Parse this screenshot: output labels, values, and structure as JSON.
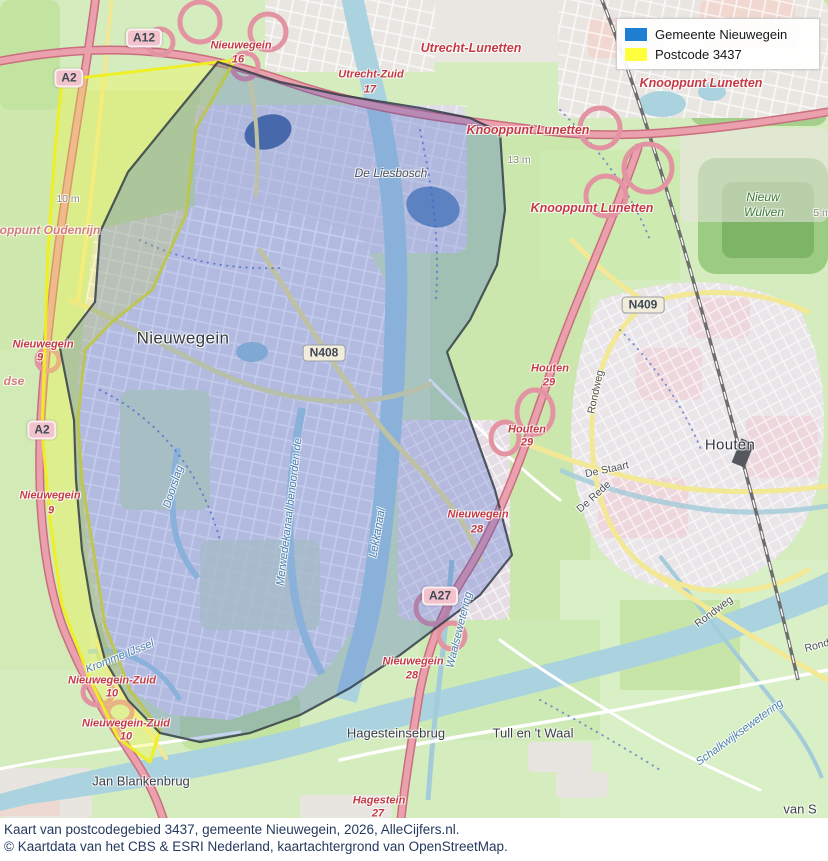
{
  "legend": {
    "items": [
      {
        "label": "Gemeente Nieuwegein",
        "color": "#1e7fd2"
      },
      {
        "label": "Postcode 3437",
        "color": "#ffff3d"
      }
    ]
  },
  "caption": {
    "line1": "Kaart van postcodegebied 3437, gemeente Nieuwegein, 2026, AlleCijfers.nl.",
    "line2": "© Kaartdata van het CBS & ESRI Nederland, kaartachtergrond van OpenStreetMap."
  },
  "map": {
    "overlay_colors": {
      "gemeente_fill": "rgba(40,80,200,0.30)",
      "postcode_fill": "rgba(250,250,60,0.32)"
    },
    "labels": [
      {
        "name": "shield-a12",
        "kind": "shield-a",
        "text": "A12",
        "x": 144,
        "y": 38
      },
      {
        "name": "shield-a2-north",
        "kind": "shield-a",
        "text": "A2",
        "x": 69,
        "y": 78
      },
      {
        "name": "shield-a2-mid",
        "kind": "shield-a",
        "text": "A2",
        "x": 42,
        "y": 430
      },
      {
        "name": "shield-a27",
        "kind": "shield-a",
        "text": "A27",
        "x": 440,
        "y": 596
      },
      {
        "name": "shield-n408",
        "kind": "shield-n",
        "text": "N408",
        "x": 324,
        "y": 353
      },
      {
        "name": "shield-n409",
        "kind": "shield-n",
        "text": "N409",
        "x": 643,
        "y": 305
      },
      {
        "name": "exit-nieuwegein-16",
        "kind": "exit",
        "text": "Nieuwegein",
        "x": 241,
        "y": 46
      },
      {
        "name": "exit-nieuwegein-16-nr",
        "kind": "exit",
        "text": "16",
        "x": 238,
        "y": 60
      },
      {
        "name": "exit-utrecht-zuid",
        "kind": "exit",
        "text": "Utrecht-Zuid",
        "x": 371,
        "y": 75
      },
      {
        "name": "exit-utrecht-zuid-nr",
        "kind": "exit",
        "text": "17",
        "x": 370,
        "y": 90
      },
      {
        "name": "label-utrecht-lunetten",
        "kind": "junction",
        "text": "Utrecht-Lunetten",
        "x": 471,
        "y": 48
      },
      {
        "name": "label-knooppunt-lunetten-1",
        "kind": "junction",
        "text": "Knooppunt Lunetten",
        "x": 701,
        "y": 83
      },
      {
        "name": "label-knooppunt-lunetten-2",
        "kind": "junction",
        "text": "Knooppunt Lunetten",
        "x": 528,
        "y": 130
      },
      {
        "name": "label-knooppunt-lunetten-3",
        "kind": "junction",
        "text": "Knooppunt Lunetten",
        "x": 592,
        "y": 208
      },
      {
        "name": "label-knooppunt-oudenrijn",
        "kind": "junction-faded",
        "text": "oppunt Oudenrijn",
        "x": 50,
        "y": 230
      },
      {
        "name": "label-dse-fragment",
        "kind": "junction-faded",
        "text": "dse",
        "x": 14,
        "y": 381
      },
      {
        "name": "exit-nieuwegein-9a",
        "kind": "exit",
        "text": "Nieuwegein",
        "x": 43,
        "y": 345
      },
      {
        "name": "exit-nieuwegein-9a-nr",
        "kind": "exit",
        "text": "9",
        "x": 40,
        "y": 358
      },
      {
        "name": "exit-nieuwegein-9b",
        "kind": "exit",
        "text": "Nieuwegein",
        "x": 50,
        "y": 496
      },
      {
        "name": "exit-nieuwegein-9b-nr",
        "kind": "exit",
        "text": "9",
        "x": 51,
        "y": 511
      },
      {
        "name": "exit-houten-29a",
        "kind": "exit",
        "text": "Houten",
        "x": 550,
        "y": 369
      },
      {
        "name": "exit-houten-29a-nr",
        "kind": "exit",
        "text": "29",
        "x": 549,
        "y": 383
      },
      {
        "name": "exit-houten-29b",
        "kind": "exit",
        "text": "Houten",
        "x": 527,
        "y": 430
      },
      {
        "name": "exit-houten-29b-nr",
        "kind": "exit",
        "text": "29",
        "x": 527,
        "y": 443
      },
      {
        "name": "exit-nieuwegein-28a",
        "kind": "exit",
        "text": "Nieuwegein",
        "x": 478,
        "y": 515
      },
      {
        "name": "exit-nieuwegein-28a-nr",
        "kind": "exit",
        "text": "28",
        "x": 477,
        "y": 530
      },
      {
        "name": "exit-nieuwegein-28b",
        "kind": "exit",
        "text": "Nieuwegein",
        "x": 413,
        "y": 662
      },
      {
        "name": "exit-nieuwegein-28b-nr",
        "kind": "exit",
        "text": "28",
        "x": 412,
        "y": 676
      },
      {
        "name": "exit-nieuwegein-zuid-10a",
        "kind": "exit",
        "text": "Nieuwegein-Zuid",
        "x": 112,
        "y": 681
      },
      {
        "name": "exit-nieuwegein-zuid-10a-nr",
        "kind": "exit",
        "text": "10",
        "x": 112,
        "y": 694
      },
      {
        "name": "exit-nieuwegein-zuid-10b",
        "kind": "exit",
        "text": "Nieuwegein-Zuid",
        "x": 126,
        "y": 724
      },
      {
        "name": "exit-nieuwegein-zuid-10b-nr",
        "kind": "exit",
        "text": "10",
        "x": 126,
        "y": 737
      },
      {
        "name": "exit-hagestein-27",
        "kind": "exit",
        "text": "Hagestein",
        "x": 379,
        "y": 801
      },
      {
        "name": "exit-hagestein-27-nr",
        "kind": "exit",
        "text": "27",
        "x": 378,
        "y": 814
      },
      {
        "name": "city-nieuwegein",
        "kind": "city",
        "text": "Nieuwegein",
        "x": 183,
        "y": 338
      },
      {
        "name": "city-houten",
        "kind": "city-sm",
        "text": "Houten",
        "x": 730,
        "y": 445
      },
      {
        "name": "town-tull-en-t-waal",
        "kind": "town",
        "text": "Tull en 't Waal",
        "x": 533,
        "y": 733
      },
      {
        "name": "town-jan-blankenbrug",
        "kind": "town",
        "text": "Jan Blankenbrug",
        "x": 141,
        "y": 781
      },
      {
        "name": "town-hagesteinsebrug",
        "kind": "town",
        "text": "Hagesteinsebrug",
        "x": 396,
        "y": 733
      },
      {
        "name": "town-van-s-fragment",
        "kind": "town",
        "text": "van S",
        "x": 800,
        "y": 809
      },
      {
        "name": "suburb-de-liesbosch",
        "kind": "suburb",
        "text": "De Liesbosch",
        "x": 391,
        "y": 173
      },
      {
        "name": "wood-nieuw-wulven-1",
        "kind": "wood",
        "text": "Nieuw",
        "x": 763,
        "y": 197
      },
      {
        "name": "wood-nieuw-wulven-2",
        "kind": "wood",
        "text": "Wulven",
        "x": 764,
        "y": 212
      },
      {
        "name": "elev-13m",
        "kind": "elev",
        "text": "13 m",
        "x": 519,
        "y": 160
      },
      {
        "name": "elev-10m",
        "kind": "elev",
        "text": "10 m",
        "x": 68,
        "y": 199
      },
      {
        "name": "elev-5m",
        "kind": "elev",
        "text": "5 m",
        "x": 822,
        "y": 213
      },
      {
        "name": "street-rondweg-1",
        "kind": "street",
        "text": "Rondweg",
        "x": 596,
        "y": 392,
        "rot": -78
      },
      {
        "name": "street-rondweg-2",
        "kind": "street",
        "text": "Rondweg",
        "x": 714,
        "y": 612,
        "rot": -37
      },
      {
        "name": "street-rondweg-3",
        "kind": "street",
        "text": "Rond",
        "x": 817,
        "y": 646,
        "rot": -15
      },
      {
        "name": "street-de-staart",
        "kind": "street",
        "text": "De Staart",
        "x": 607,
        "y": 470,
        "rot": -12
      },
      {
        "name": "street-de-rede",
        "kind": "street",
        "text": "De Rede",
        "x": 594,
        "y": 497,
        "rot": -42
      },
      {
        "name": "water-lekkanaal",
        "kind": "water-lbl",
        "text": "Lekkanaal",
        "x": 378,
        "y": 533,
        "rot": -80
      },
      {
        "name": "water-merwedekanaal",
        "kind": "water-lbl",
        "text": "Merwedekanaal benoorden de",
        "x": 290,
        "y": 512,
        "rot": -83
      },
      {
        "name": "water-doorslag",
        "kind": "water-lbl",
        "text": "Doorslag",
        "x": 174,
        "y": 487,
        "rot": -72
      },
      {
        "name": "water-waalsewetering",
        "kind": "water-lbl",
        "text": "Waalsewetering",
        "x": 460,
        "y": 630,
        "rot": -76
      },
      {
        "name": "water-schalkwijksewetering",
        "kind": "water-lbl",
        "text": "Schalkwijksewetering",
        "x": 740,
        "y": 733,
        "rot": -36
      },
      {
        "name": "water-kromme-ijssel",
        "kind": "water-lbl",
        "text": "Kromme IJssel",
        "x": 120,
        "y": 657,
        "rot": -22
      }
    ]
  }
}
